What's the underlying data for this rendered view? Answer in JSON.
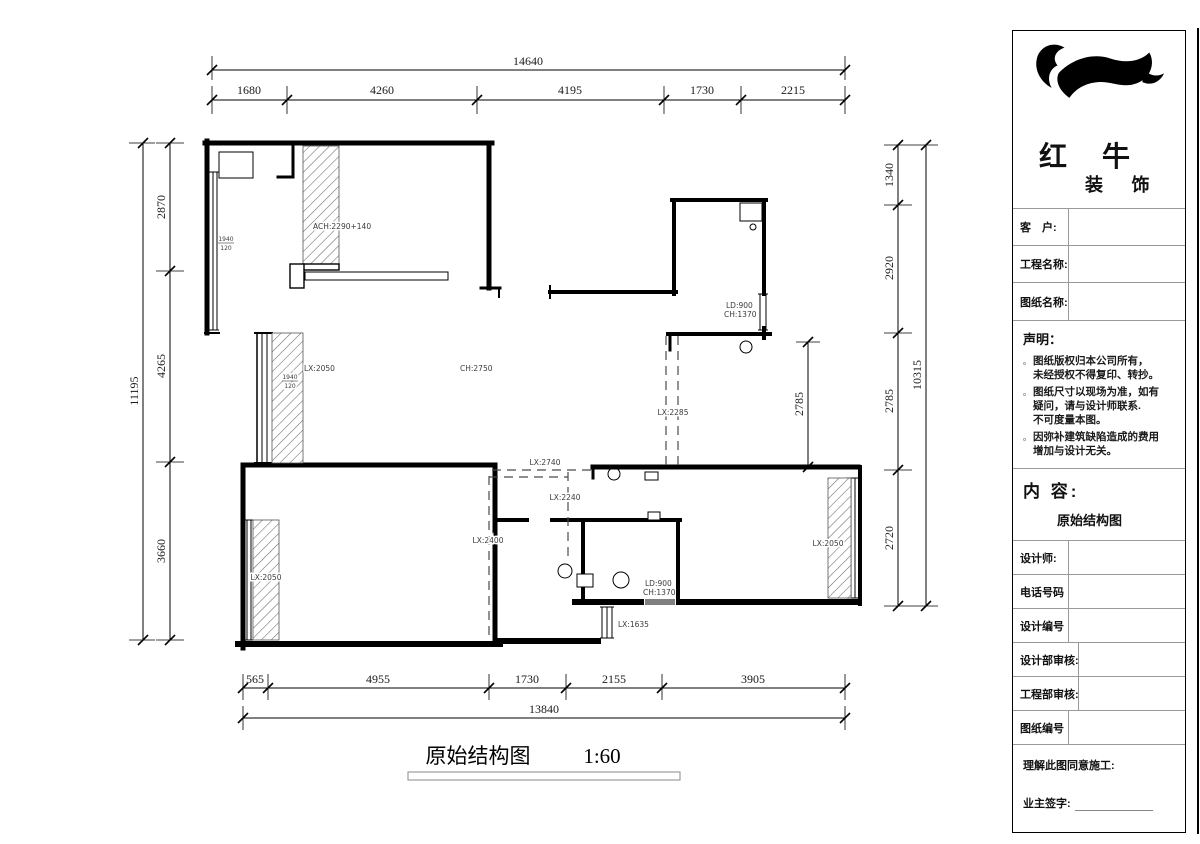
{
  "plan": {
    "title": "原始结构图",
    "scale": "1:60",
    "labels": {
      "ach_top": "ACH:2290+140",
      "win_frac_num": "1940",
      "win_frac_den": "120",
      "lx_mid_left": "LX:2050",
      "ch_main": "CH:2750",
      "ld_top": "LD:900",
      "ch_top": "CH:1370",
      "lx_2285": "LX:2285",
      "lx_2740": "LX:2740",
      "lx_2240": "LX:2240",
      "lx_2400": "LX:2400",
      "lx_bottom_left": "LX:2050",
      "ld_bath": "LD:900",
      "ch_bath": "CH:1370",
      "lx_1635": "LX:1635",
      "lx_right": "LX:2050"
    },
    "dims": {
      "top": {
        "total": "14640",
        "segments": [
          "1680",
          "4260",
          "4195",
          "1730",
          "2215"
        ]
      },
      "bottom": {
        "total": "13840",
        "segments": [
          "565",
          "4955",
          "1730",
          "2155",
          "3905"
        ]
      },
      "left": {
        "total": "11195",
        "segments": [
          "2870",
          "4265",
          "3660"
        ]
      },
      "right": {
        "total": "10315",
        "segments": [
          "1340",
          "2920",
          "2785",
          "2720"
        ]
      },
      "interior_right": "2785"
    }
  },
  "titleblock": {
    "brand": {
      "line1": "红 牛",
      "line2": "装 饰"
    },
    "fields_top": [
      "客　户:",
      "工程名称:",
      "图纸名称:"
    ],
    "statement": {
      "heading": "声明：",
      "bullet": "。",
      "items": [
        [
          "图纸版权归本公司所有，",
          "未经授权不得复印、转抄。"
        ],
        [
          "图纸尺寸以现场为准，如有",
          "疑问，请与设计师联系.",
          "不可度量本图。"
        ],
        [
          "因弥补建筑缺陷造成的费用",
          "增加与设计无关。"
        ]
      ]
    },
    "content": {
      "heading": "内 容:",
      "value": "原始结构图"
    },
    "fields_bottom": [
      "设计师:",
      "电话号码",
      "设计编号",
      "设计部审核:",
      "工程部审核:",
      "图纸编号"
    ],
    "footer": {
      "line1": "理解此图同意施工:",
      "line2": "业主签字:"
    }
  }
}
